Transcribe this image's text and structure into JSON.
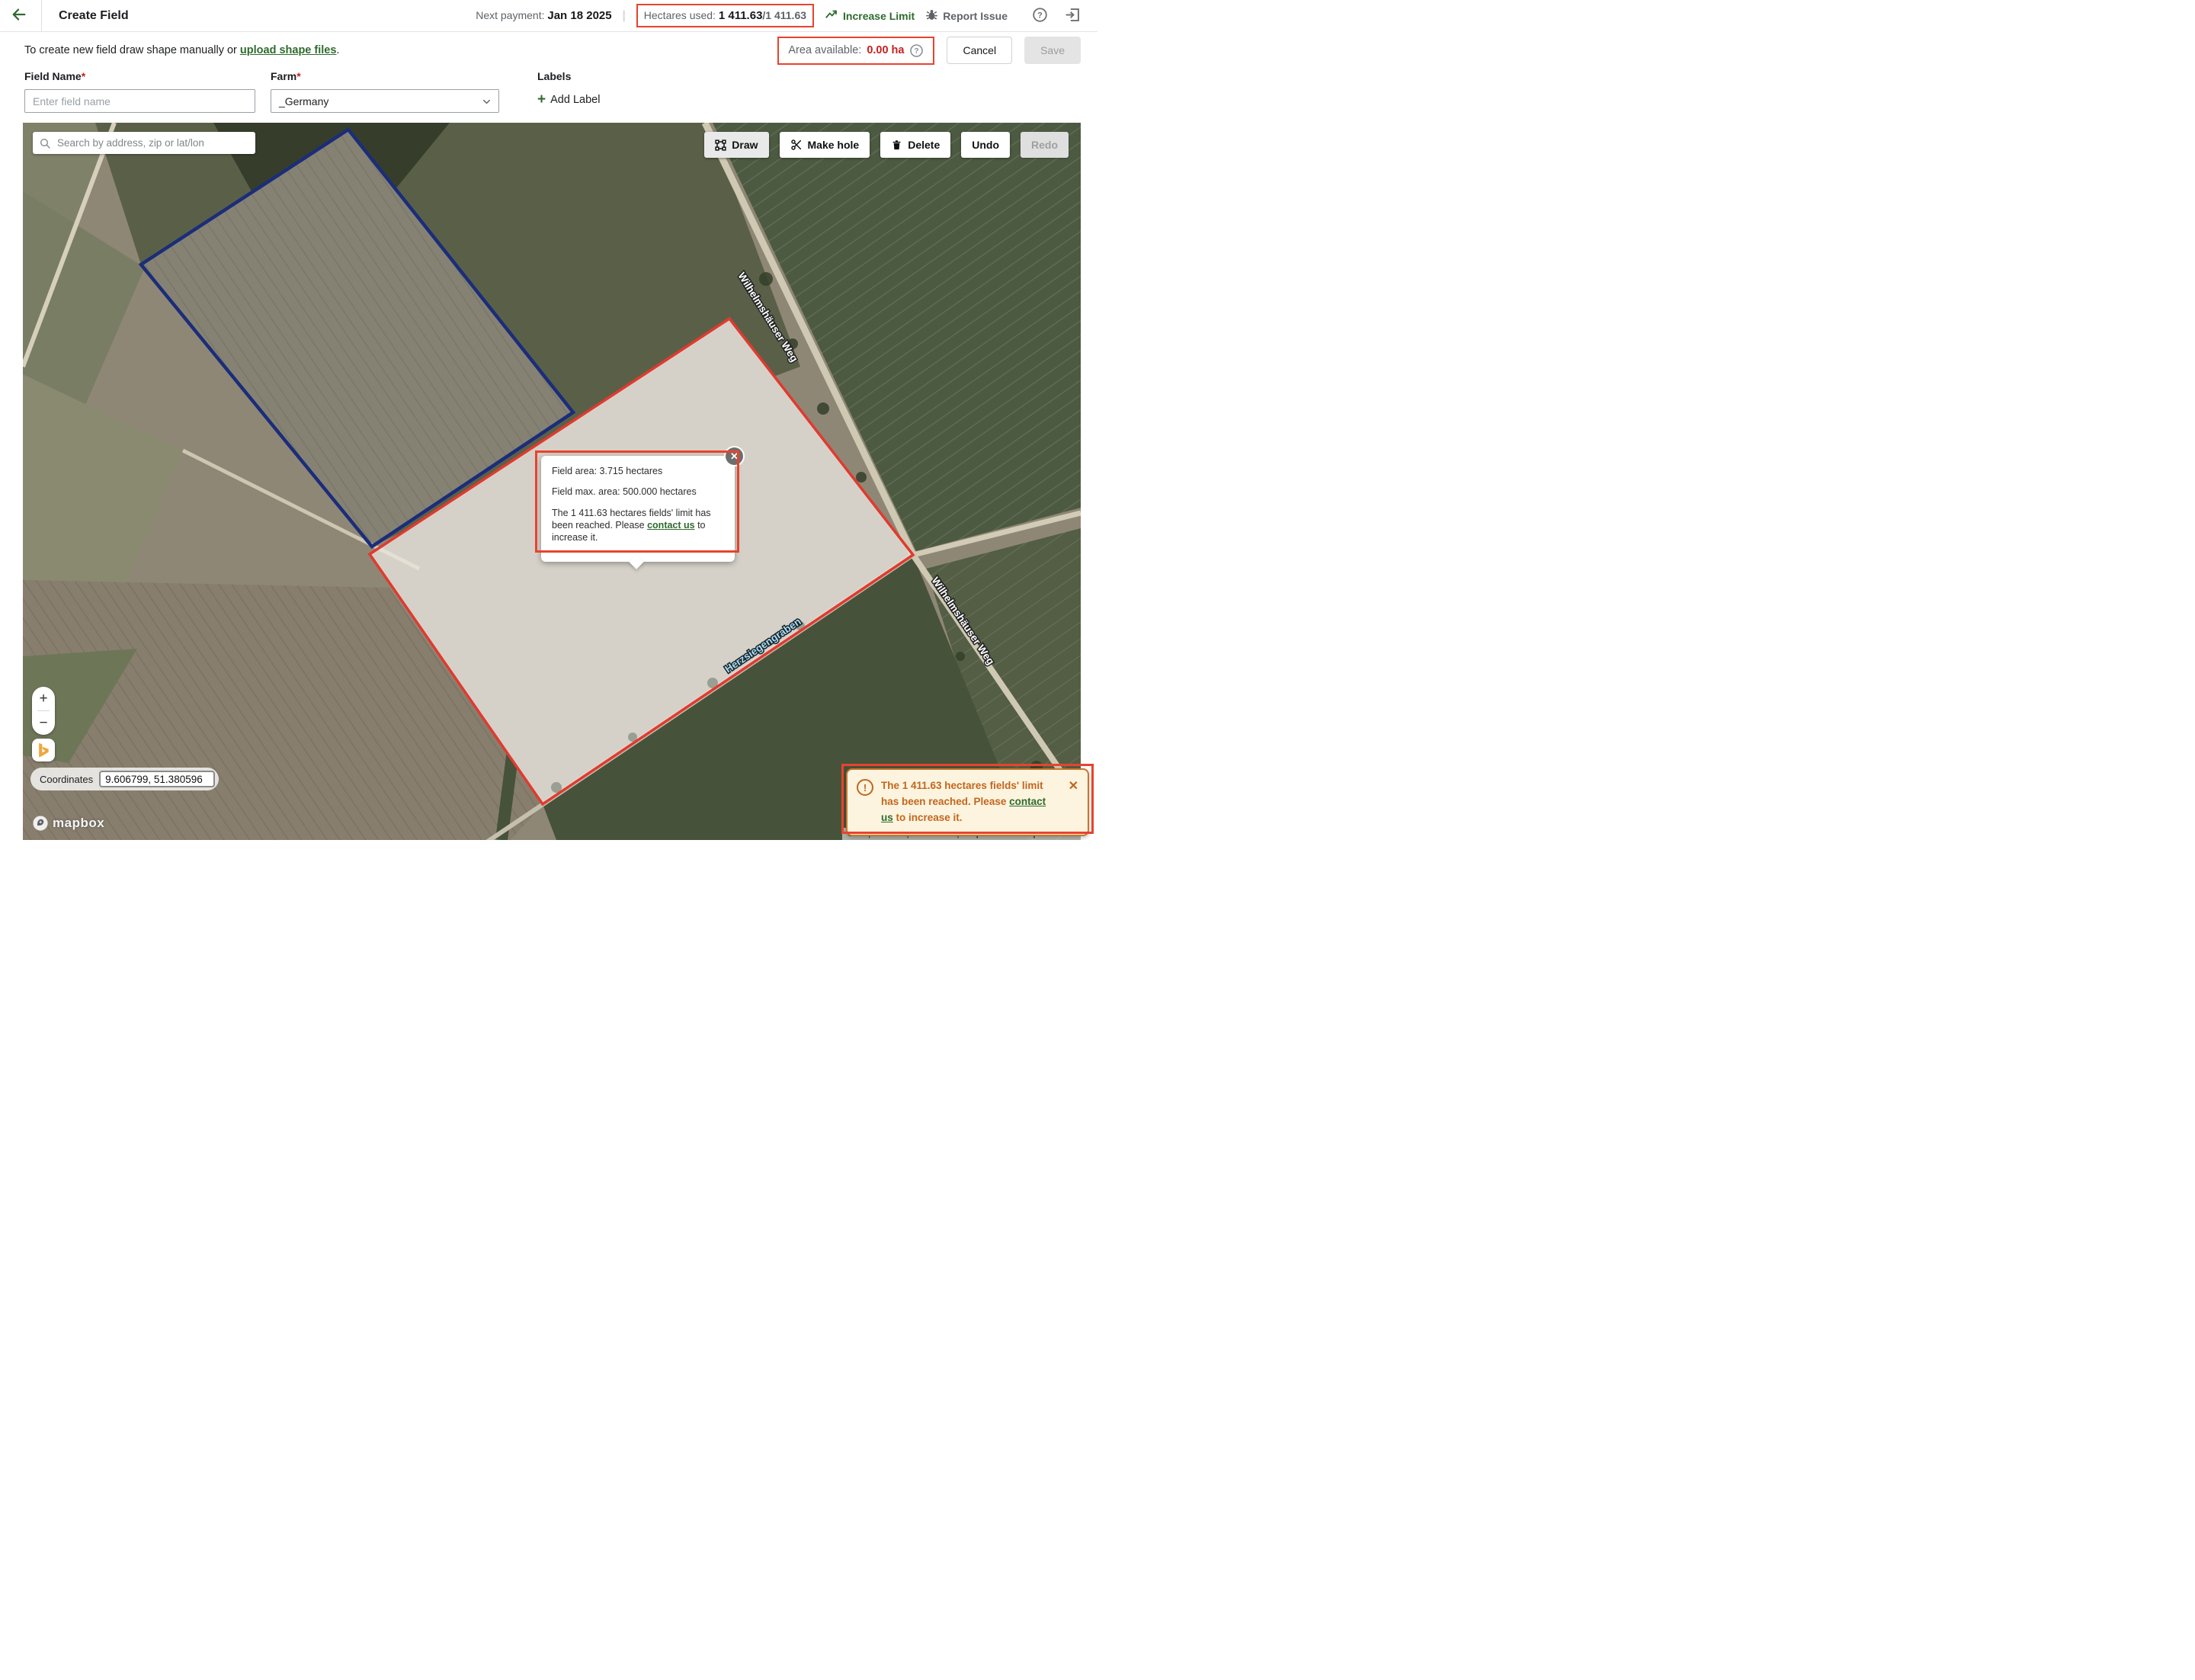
{
  "colors": {
    "accent_green": "#2e6b2e",
    "annotation_red": "#e8432e",
    "error_red": "#c5221f",
    "toast_orange": "#c2661f",
    "polygon_blue": "#1b2d7a",
    "polygon_red": "#e03a2f"
  },
  "header": {
    "title": "Create Field",
    "next_payment_label": "Next payment:",
    "next_payment_value": "Jan 18 2025",
    "hectares_label": "Hectares used:",
    "hectares_used": "1 411.63",
    "hectares_total": "/1 411.63",
    "increase_limit": "Increase Limit",
    "report_issue": "Report Issue"
  },
  "subheader": {
    "instruction_prefix": "To create new field draw shape manually or ",
    "upload_link": "upload shape files",
    "instruction_suffix": ".",
    "area_label": "Area available:",
    "area_value": "0.00 ha",
    "cancel": "Cancel",
    "save": "Save"
  },
  "form": {
    "field_name_label": "Field Name",
    "field_name_required": "*",
    "field_name_placeholder": "Enter field name",
    "farm_label": "Farm",
    "farm_required": "*",
    "farm_value": "_Germany",
    "labels_label": "Labels",
    "add_label_plus": "+",
    "add_label_text": "Add Label"
  },
  "map": {
    "search_placeholder": "Search by address, zip or lat/lon",
    "toolbar": {
      "draw": "Draw",
      "make_hole": "Make hole",
      "delete": "Delete",
      "undo": "Undo",
      "redo": "Redo"
    },
    "popup": {
      "line1": "Field area: 3.715 hectares",
      "line2": "Field max. area: 500.000 hectares",
      "line3_prefix": "The 1 411.63 hectares fields' limit has been reached. Please ",
      "line3_link": "contact us",
      "line3_suffix": " to increase it.",
      "close_glyph": "✕"
    },
    "road_label_1": "Wilhelmshäuser Weg",
    "road_label_2": "Wilhelmshäuser Weg",
    "water_label": "Herzsiegengraben",
    "zoom_in": "+",
    "zoom_out": "−",
    "coordinates_label": "Coordinates",
    "coordinates_value": "9.606799, 51.380596",
    "logo_text": "mapbox",
    "attribution": {
      "mapbox": "© Mapbox",
      "osm": "© OpenStreetMap",
      "improve": "Improve this map",
      "maxar": "© Maxar"
    }
  },
  "toast": {
    "icon_glyph": "!",
    "prefix": "The 1 411.63 hectares fields' limit has been reached. Please ",
    "link": "contact us",
    "suffix": " to increase it.",
    "close_glyph": "✕"
  }
}
